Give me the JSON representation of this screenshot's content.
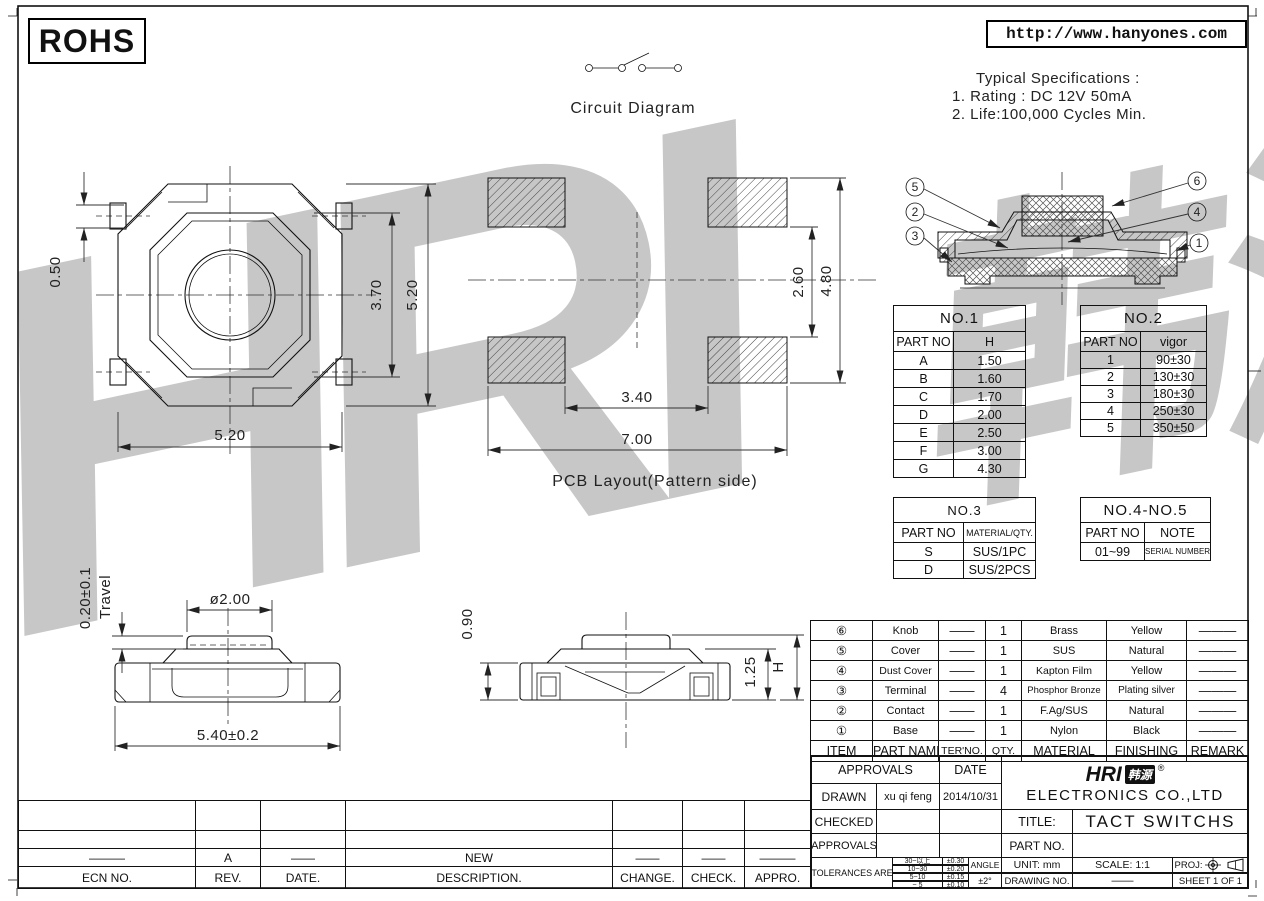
{
  "header": {
    "rohs_label": "ROHS",
    "url": "http://www.hanyones.com",
    "circuit_label": "Circuit Diagram",
    "specs_title": "Typical Specifications :",
    "specs_line1": "1. Rating : DC 12V 50mA",
    "specs_line2": "2. Life:100,000 Cycles Min."
  },
  "drawings": {
    "top_view": {
      "dim_tab": "0.50",
      "dim_inner": "3.70",
      "dim_outer_v": "5.20",
      "dim_outer_h": "5.20"
    },
    "pcb": {
      "label": "PCB Layout(Pattern side)",
      "dim_pad_gap_v": "2.60",
      "dim_outer_v": "4.80",
      "dim_pad_gap_h": "3.40",
      "dim_outer_h": "7.00"
    },
    "side_front": {
      "dim_travel": "0.20±0.1",
      "travel_label": "Travel",
      "dim_knob_dia": "ø2.00",
      "dim_width": "5.40±0.2"
    },
    "side_right": {
      "dim_base_h": "0.90",
      "dim_cover_h": "1.25",
      "dim_total_h": "H"
    },
    "section": {
      "callouts": [
        "5",
        "2",
        "3",
        "6",
        "4",
        "1"
      ]
    }
  },
  "tables": {
    "no1": {
      "title": "NO.1",
      "headers": [
        "PART NO",
        "H"
      ],
      "rows": [
        [
          "A",
          "1.50"
        ],
        [
          "B",
          "1.60"
        ],
        [
          "C",
          "1.70"
        ],
        [
          "D",
          "2.00"
        ],
        [
          "E",
          "2.50"
        ],
        [
          "F",
          "3.00"
        ],
        [
          "G",
          "4.30"
        ]
      ]
    },
    "no2": {
      "title": "NO.2",
      "headers": [
        "PART NO",
        "vigor"
      ],
      "rows": [
        [
          "1",
          "90±30"
        ],
        [
          "2",
          "130±30"
        ],
        [
          "3",
          "180±30"
        ],
        [
          "4",
          "250±30"
        ],
        [
          "5",
          "350±50"
        ]
      ]
    },
    "no3": {
      "title": "NO.3",
      "headers": [
        "PART NO",
        "MATERIAL/QTY."
      ],
      "rows": [
        [
          "S",
          "SUS/1PC"
        ],
        [
          "D",
          "SUS/2PCS"
        ]
      ]
    },
    "no45": {
      "title": "NO.4-NO.5",
      "headers": [
        "PART NO",
        "NOTE"
      ],
      "rows": [
        [
          "01~99",
          "SERIAL NUMBER"
        ]
      ]
    }
  },
  "bom": {
    "headers": [
      "ITEM",
      "PART NAME",
      "TER'NO.",
      "QTY.",
      "MATERIAL",
      "FINISHING",
      "REMARK"
    ],
    "rows": [
      {
        "item": "⑥",
        "part": "Knob",
        "ter": "——",
        "qty": "1",
        "material": "Brass",
        "finish": "Yellow",
        "remark": "———"
      },
      {
        "item": "⑤",
        "part": "Cover",
        "ter": "——",
        "qty": "1",
        "material": "SUS",
        "finish": "Natural",
        "remark": "———"
      },
      {
        "item": "④",
        "part": "Dust Cover",
        "ter": "——",
        "qty": "1",
        "material": "Kapton Film",
        "finish": "Yellow",
        "remark": "———"
      },
      {
        "item": "③",
        "part": "Terminal",
        "ter": "——",
        "qty": "4",
        "material": "Phosphor Bronze",
        "finish": "Plating silver",
        "remark": "———"
      },
      {
        "item": "②",
        "part": "Contact",
        "ter": "——",
        "qty": "1",
        "material": "F.Ag/SUS",
        "finish": "Natural",
        "remark": "———"
      },
      {
        "item": "①",
        "part": "Base",
        "ter": "——",
        "qty": "1",
        "material": "Nylon",
        "finish": "Black",
        "remark": "———"
      }
    ]
  },
  "title_block": {
    "approvals_header": "APPROVALS",
    "date_header": "DATE",
    "drawn_label": "DRAWN",
    "drawn_name": "xu qi feng",
    "drawn_date": "2014/10/31",
    "checked_label": "CHECKED",
    "approved_label": "APPROVALS",
    "tolerances_label": "TOLERANCES ARE",
    "tol_rows": [
      [
        "30~以上",
        "±0.30"
      ],
      [
        "10~30",
        "±0.20"
      ],
      [
        "5~10",
        "±0.15"
      ],
      [
        "~ 5",
        "±0.10"
      ]
    ],
    "angle_label": "ANGLE",
    "angle_value": "±2°",
    "logo_text": "HRI",
    "logo_cn": "韩源",
    "logo_reg": "®",
    "company": "ELECTRONICS CO.,LTD",
    "title_label": "TITLE:",
    "title_value": "TACT SWITCHS",
    "part_no_label": "PART NO.",
    "unit_text": "UNIT: mm",
    "scale_text": "SCALE: 1:1",
    "proj_label": "PROJ:",
    "drawing_no_label": "DRAWING NO.",
    "drawing_no_value": "——",
    "sheet_text": "SHEET 1 OF 1"
  },
  "revision": {
    "headers": [
      "ECN NO.",
      "REV.",
      "DATE.",
      "DESCRIPTION.",
      "CHANGE.",
      "CHECK.",
      "APPRO."
    ],
    "row": [
      "———",
      "A",
      "——",
      "NEW",
      "——",
      "——",
      "———"
    ]
  },
  "watermark": {
    "text1": "HRI",
    "text2": "韩源"
  }
}
